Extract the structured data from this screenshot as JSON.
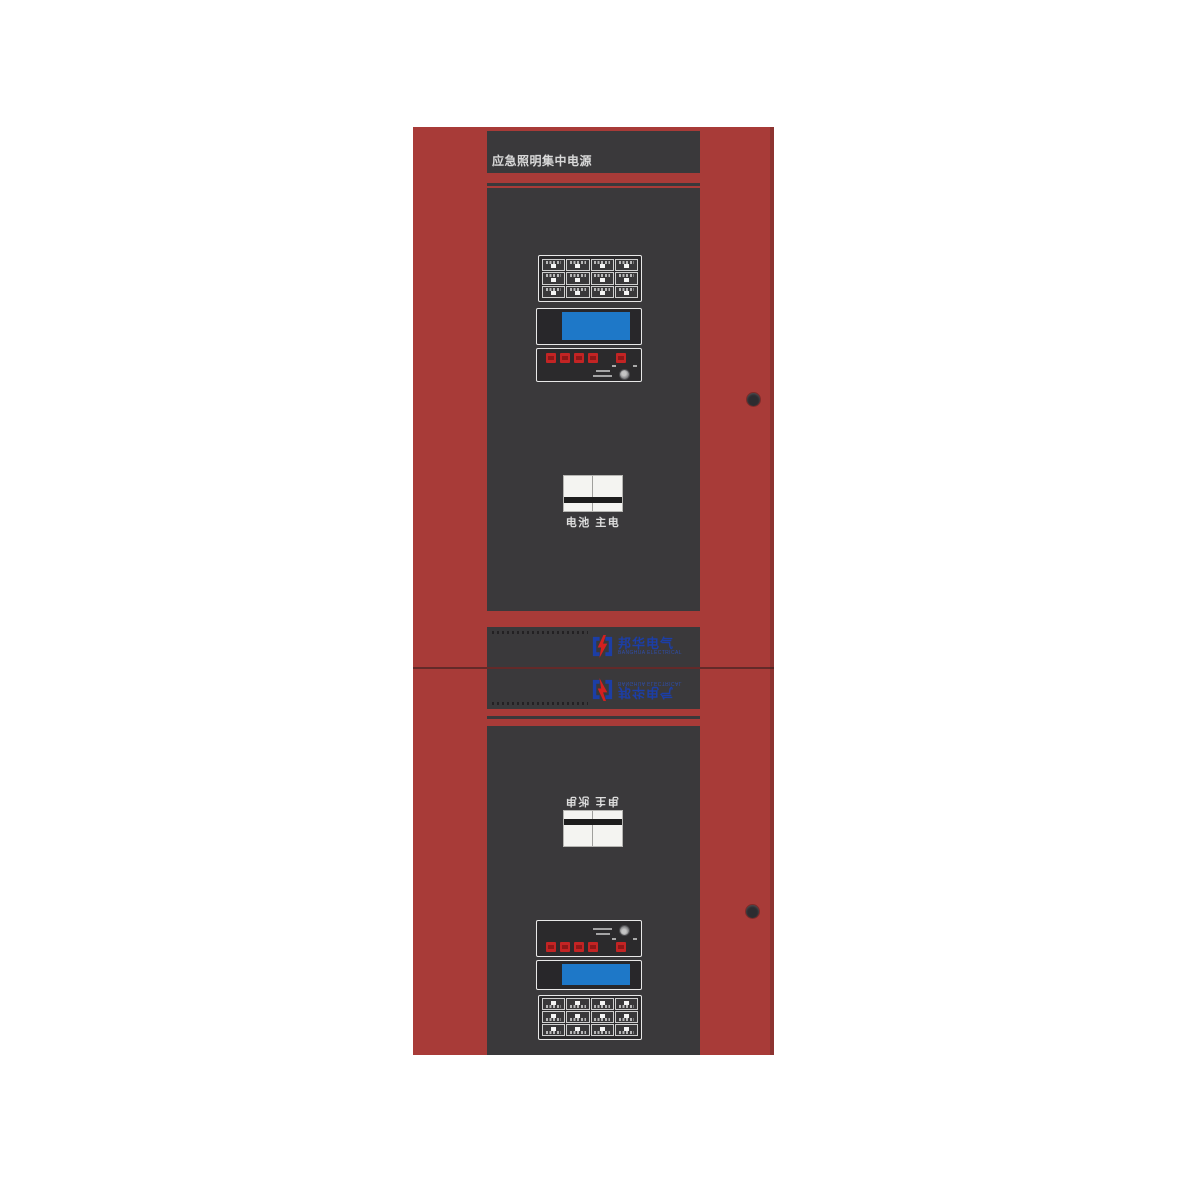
{
  "product": {
    "title": "应急照明集中电源",
    "breaker_label": "电池 主电",
    "brand": {
      "cn": "邦华电气",
      "en": "BANGHUA ELECTRICAL"
    },
    "keypad": {
      "rows": 3,
      "cols": 4,
      "key_color": "#f4f4f4"
    },
    "indicators": {
      "red_button_count": 5,
      "button_color": "#c32424"
    },
    "display": {
      "screen_color": "#1e78c8"
    },
    "colors": {
      "cabinet_red": "#a83b38",
      "cabinet_edge": "#8d3431",
      "panel_dark": "#3a393b",
      "logo_blue": "#1c3ea6",
      "bolt_red": "#d4201f"
    }
  }
}
